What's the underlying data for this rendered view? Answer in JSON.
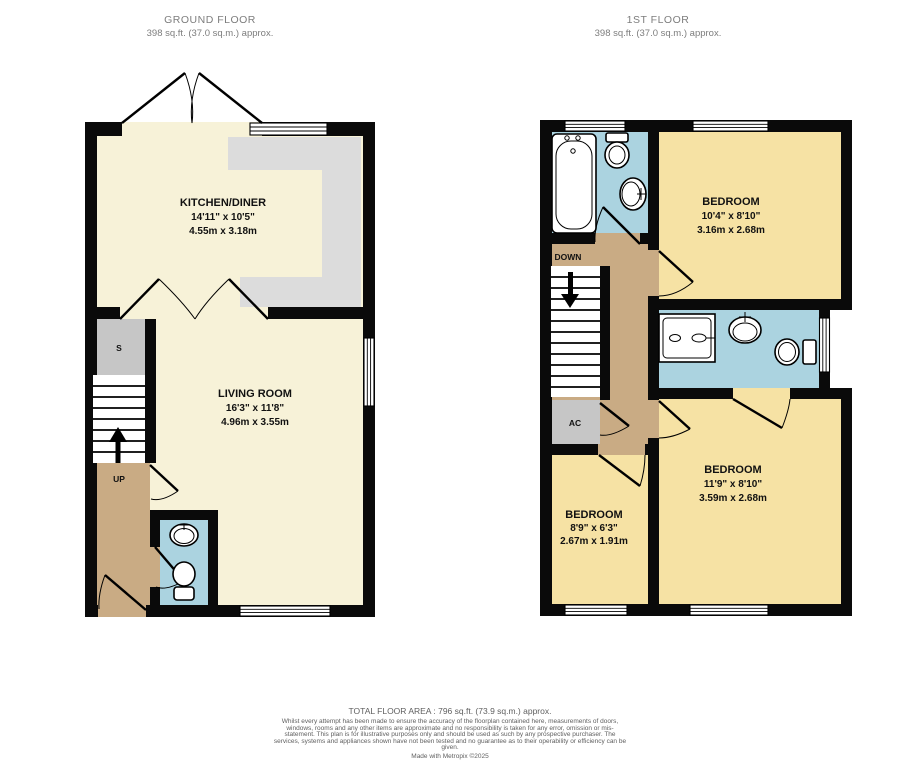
{
  "colors": {
    "wall": "#0a0a0a",
    "cream": "#f7f2d8",
    "yellow": "#f6e2a4",
    "tan": "#c9ab84",
    "blue": "#abd3e0",
    "unit": "#c6c6c6",
    "counter": "#dcdcdc",
    "header": "#7d7d7d",
    "footer": "#606060"
  },
  "ground_floor": {
    "title": "GROUND FLOOR",
    "area": "398 sq.ft. (37.0 sq.m.) approx.",
    "rooms": {
      "kitchen": {
        "name": "KITCHEN/DINER",
        "imperial": "14'11\" x 10'5\"",
        "metric": "4.55m x 3.18m"
      },
      "living": {
        "name": "LIVING ROOM",
        "imperial": "16'3\" x 11'8\"",
        "metric": "4.96m x 3.55m"
      }
    },
    "labels": {
      "storage": "S",
      "up": "UP"
    }
  },
  "first_floor": {
    "title": "1ST FLOOR",
    "area": "398 sq.ft. (37.0 sq.m.) approx.",
    "rooms": {
      "bedroom1": {
        "name": "BEDROOM",
        "imperial": "10'4\" x 8'10\"",
        "metric": "3.16m x 2.68m"
      },
      "bedroom2": {
        "name": "BEDROOM",
        "imperial": "11'9\" x 8'10\"",
        "metric": "3.59m x 2.68m"
      },
      "bedroom3": {
        "name": "BEDROOM",
        "imperial": "8'9\" x 6'3\"",
        "metric": "2.67m x 1.91m"
      }
    },
    "labels": {
      "down": "DOWN",
      "ac": "AC"
    }
  },
  "footer": {
    "total": "TOTAL FLOOR AREA : 796 sq.ft. (73.9 sq.m.) approx.",
    "disclaimer": "Whilst every attempt has been made to ensure the accuracy of the floorplan contained here, measurements of doors, windows, rooms and any other items are approximate and no responsibility is taken for any error, omission or mis-statement. This plan is for illustrative purposes only and should be used as such by any prospective purchaser. The services, systems and appliances shown have not been tested and no guarantee as to their operability or efficiency can be given.",
    "credit": "Made with Metropix ©2025"
  }
}
